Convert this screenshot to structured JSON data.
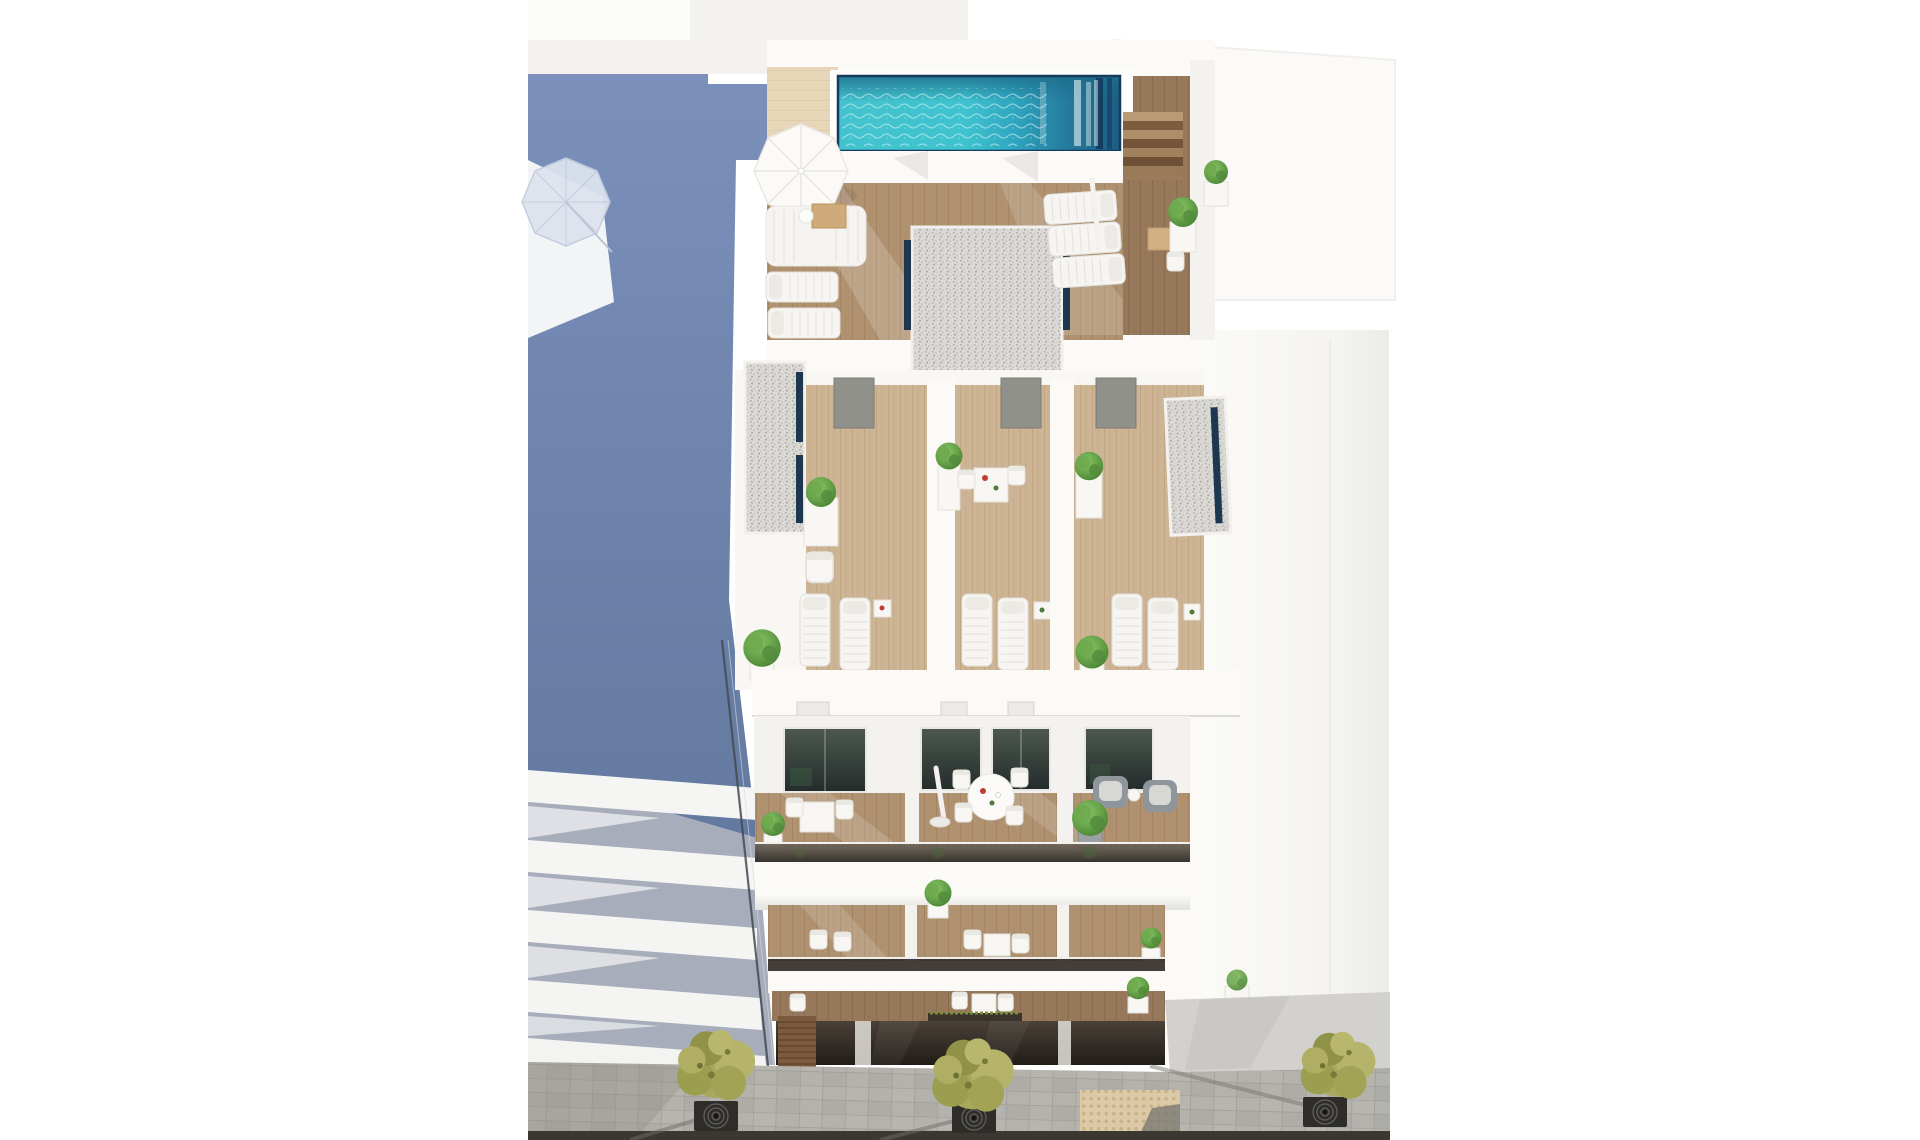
{
  "scene": {
    "kind": "aerial-3d-architectural-render",
    "subject": "modern-white-apartment-building-with-rooftop-pool",
    "rooftop": {
      "pools": 1,
      "open_parasols": 1,
      "closed_parasols": 1,
      "sun_loungers": 5,
      "outdoor_sofas": 1,
      "potted_plants": 2,
      "wood_stairs": 1,
      "gravel_roof_patches": 1
    },
    "attic_level": {
      "private_terraces": 3,
      "sun_loungers": 6,
      "bistro_sets": 1,
      "potted_plants": 7,
      "gravel_roof_strips": 2,
      "terrace_doors": 3
    },
    "facade": {
      "balcony_rows": 3,
      "dark_glass_windows": 4,
      "round_dining_sets": 1,
      "square_table_sets": 3,
      "closed_parasols": 1,
      "armchairs": 2,
      "potted_plants": 9,
      "glass_balustrades": 3
    },
    "ground_level": {
      "garage_doors": 1,
      "storefront_glass_bands": 1
    },
    "street": {
      "trees": 3,
      "tree_grates": 3,
      "tactile_paving_patches": 1,
      "road_strips": 1
    },
    "neighbors": {
      "left_building_in_blue_shadow": 1,
      "left_building_balcony_slabs": 5,
      "shadow_parasols": 1,
      "right_building": 1
    }
  },
  "palette": {
    "background": "#ffffff",
    "white_sunlit": "#fbfaf7",
    "white_soft": "#f3f2ee",
    "white_shade": "#e9e8e4",
    "shadow_blue_top": "#7b90bb",
    "shadow_blue_bottom": "#63799f",
    "slab_gap_gray": "#a7adbb",
    "pool_turquoise": "#43c6d0",
    "pool_deep": "#1d5c82",
    "pool_border_navy": "#153a5c",
    "skylight_navy": "#1d3750",
    "deck_beige": "#e7d7b8",
    "wood_light": "#cdb494",
    "wood_medium": "#b09271",
    "wood_dark": "#97785a",
    "gravel_gray": "#dcdad6",
    "glass_dark": "#242d2c",
    "storefront_dark": "#211c18",
    "pavement_gray": "#b4b2ac",
    "tactile_tan": "#dccaa6",
    "road_dark": "#3b3831",
    "tree_olive": "#a8a95c",
    "plant_green": "#5f9c44",
    "door_olive": "#90918a"
  }
}
